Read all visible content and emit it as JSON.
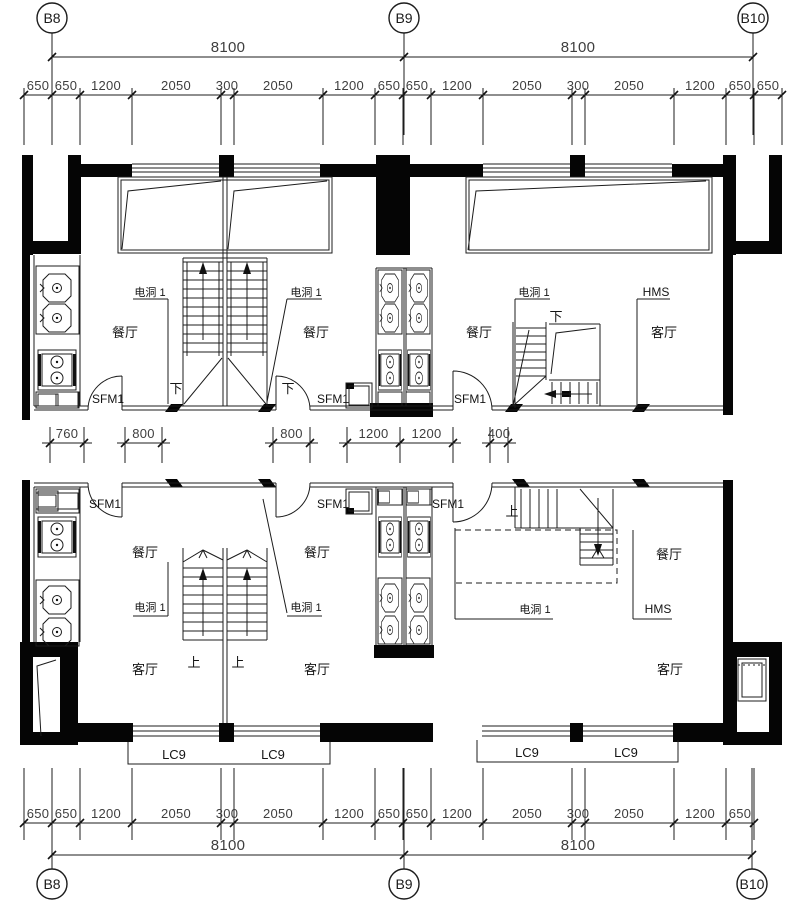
{
  "grid": {
    "top": {
      "y": 18,
      "items": [
        {
          "label": "B8",
          "x": 52
        },
        {
          "label": "B9",
          "x": 404
        },
        {
          "label": "B10",
          "x": 753
        }
      ]
    },
    "bottom": {
      "y": 884,
      "items": [
        {
          "label": "B8",
          "x": 52
        },
        {
          "label": "B9",
          "x": 404
        },
        {
          "label": "B10",
          "x": 752
        }
      ]
    }
  },
  "dimensions": {
    "top_overall": {
      "y": 57,
      "fs": 15,
      "ticks": [
        52,
        404,
        753
      ],
      "labels": [
        {
          "t": "8100",
          "x": 228
        },
        {
          "t": "8100",
          "x": 578
        }
      ]
    },
    "top_detail": {
      "y": 95,
      "fs": 13,
      "ext": [
        7,
        50
      ],
      "ticks": [
        24,
        52,
        80,
        132,
        221,
        234,
        323,
        375,
        403,
        431,
        483,
        572,
        585,
        674,
        726,
        754,
        782
      ],
      "labels": [
        {
          "t": "650",
          "x": 38
        },
        {
          "t": "650",
          "x": 66
        },
        {
          "t": "1200",
          "x": 106
        },
        {
          "t": "2050",
          "x": 176
        },
        {
          "t": "300",
          "x": 227
        },
        {
          "t": "2050",
          "x": 278
        },
        {
          "t": "1200",
          "x": 349
        },
        {
          "t": "650",
          "x": 389
        },
        {
          "t": "650",
          "x": 417
        },
        {
          "t": "1200",
          "x": 457
        },
        {
          "t": "2050",
          "x": 527
        },
        {
          "t": "300",
          "x": 578
        },
        {
          "t": "2050",
          "x": 629
        },
        {
          "t": "1200",
          "x": 700
        },
        {
          "t": "650",
          "x": 740
        },
        {
          "t": "650",
          "x": 768
        }
      ]
    },
    "middle": {
      "y": 443,
      "segments": [
        {
          "t": "760",
          "x1": 50,
          "x2": 84
        },
        {
          "t": "800",
          "x1": 125,
          "x2": 162
        },
        {
          "t": "800",
          "x1": 273,
          "x2": 310
        },
        {
          "t": "1200",
          "x1": 347,
          "x2": 400
        },
        {
          "t": "1200",
          "x1": 400,
          "x2": 453
        },
        {
          "t": "400",
          "x1": 490,
          "x2": 508
        }
      ]
    },
    "bottom_detail": {
      "y": 823,
      "fs": 13,
      "ext": [
        55,
        17
      ],
      "ticks": [
        24,
        52,
        80,
        132,
        221,
        234,
        323,
        375,
        403,
        431,
        483,
        572,
        585,
        674,
        726,
        754
      ],
      "labels": [
        {
          "t": "650",
          "x": 38
        },
        {
          "t": "650",
          "x": 66
        },
        {
          "t": "1200",
          "x": 106
        },
        {
          "t": "2050",
          "x": 176
        },
        {
          "t": "300",
          "x": 227
        },
        {
          "t": "2050",
          "x": 278
        },
        {
          "t": "1200",
          "x": 349
        },
        {
          "t": "650",
          "x": 389
        },
        {
          "t": "650",
          "x": 417
        },
        {
          "t": "1200",
          "x": 457
        },
        {
          "t": "2050",
          "x": 527
        },
        {
          "t": "300",
          "x": 578
        },
        {
          "t": "2050",
          "x": 629
        },
        {
          "t": "1200",
          "x": 700
        },
        {
          "t": "650",
          "x": 740
        }
      ]
    },
    "bottom_overall": {
      "y": 855,
      "fs": 15,
      "ticks": [
        52,
        404,
        752
      ],
      "labels": [
        {
          "t": "8100",
          "x": 228
        },
        {
          "t": "8100",
          "x": 578
        }
      ]
    }
  },
  "plans": {
    "upper": {
      "labels": [
        {
          "t": "电洞 1",
          "x": 150,
          "y": 296,
          "s": 11
        },
        {
          "t": "电洞 1",
          "x": 306,
          "y": 296,
          "s": 11
        },
        {
          "t": "电洞 1",
          "x": 534,
          "y": 296,
          "s": 11
        },
        {
          "t": "HMS",
          "x": 656,
          "y": 296,
          "s": 12
        },
        {
          "t": "餐厅",
          "x": 125,
          "y": 337,
          "s": 13
        },
        {
          "t": "餐厅",
          "x": 316,
          "y": 337,
          "s": 13
        },
        {
          "t": "餐厅",
          "x": 479,
          "y": 337,
          "s": 13
        },
        {
          "t": "客厅",
          "x": 664,
          "y": 337,
          "s": 13
        },
        {
          "t": "下",
          "x": 176,
          "y": 393,
          "s": 13
        },
        {
          "t": "下",
          "x": 288,
          "y": 393,
          "s": 13
        },
        {
          "t": "下",
          "x": 556,
          "y": 321,
          "s": 13
        },
        {
          "t": "SFM1",
          "x": 108,
          "y": 403,
          "s": 12
        },
        {
          "t": "SFM1",
          "x": 333,
          "y": 403,
          "s": 12
        },
        {
          "t": "SFM1",
          "x": 470,
          "y": 403,
          "s": 12
        }
      ]
    },
    "lower": {
      "labels": [
        {
          "t": "SFM1",
          "x": 105,
          "y": 508,
          "s": 12
        },
        {
          "t": "SFM1",
          "x": 333,
          "y": 508,
          "s": 12
        },
        {
          "t": "SFM1",
          "x": 448,
          "y": 508,
          "s": 12
        },
        {
          "t": "上",
          "x": 512,
          "y": 516,
          "s": 13
        },
        {
          "t": "餐厅",
          "x": 145,
          "y": 557,
          "s": 13
        },
        {
          "t": "餐厅",
          "x": 317,
          "y": 557,
          "s": 13
        },
        {
          "t": "餐厅",
          "x": 669,
          "y": 559,
          "s": 13
        },
        {
          "t": "电洞 1",
          "x": 150,
          "y": 611,
          "s": 11
        },
        {
          "t": "电洞 1",
          "x": 306,
          "y": 611,
          "s": 11
        },
        {
          "t": "电洞 1",
          "x": 535,
          "y": 613,
          "s": 11
        },
        {
          "t": "HMS",
          "x": 658,
          "y": 613,
          "s": 12
        },
        {
          "t": "上",
          "x": 194,
          "y": 667,
          "s": 13
        },
        {
          "t": "上",
          "x": 238,
          "y": 667,
          "s": 13
        },
        {
          "t": "客厅",
          "x": 145,
          "y": 674,
          "s": 13
        },
        {
          "t": "客厅",
          "x": 317,
          "y": 674,
          "s": 13
        },
        {
          "t": "客厅",
          "x": 670,
          "y": 674,
          "s": 13
        },
        {
          "t": "LC9",
          "x": 174,
          "y": 759,
          "s": 13
        },
        {
          "t": "LC9",
          "x": 273,
          "y": 759,
          "s": 13
        },
        {
          "t": "LC9",
          "x": 527,
          "y": 757,
          "s": 13
        },
        {
          "t": "LC9",
          "x": 626,
          "y": 757,
          "s": 13
        }
      ]
    }
  }
}
